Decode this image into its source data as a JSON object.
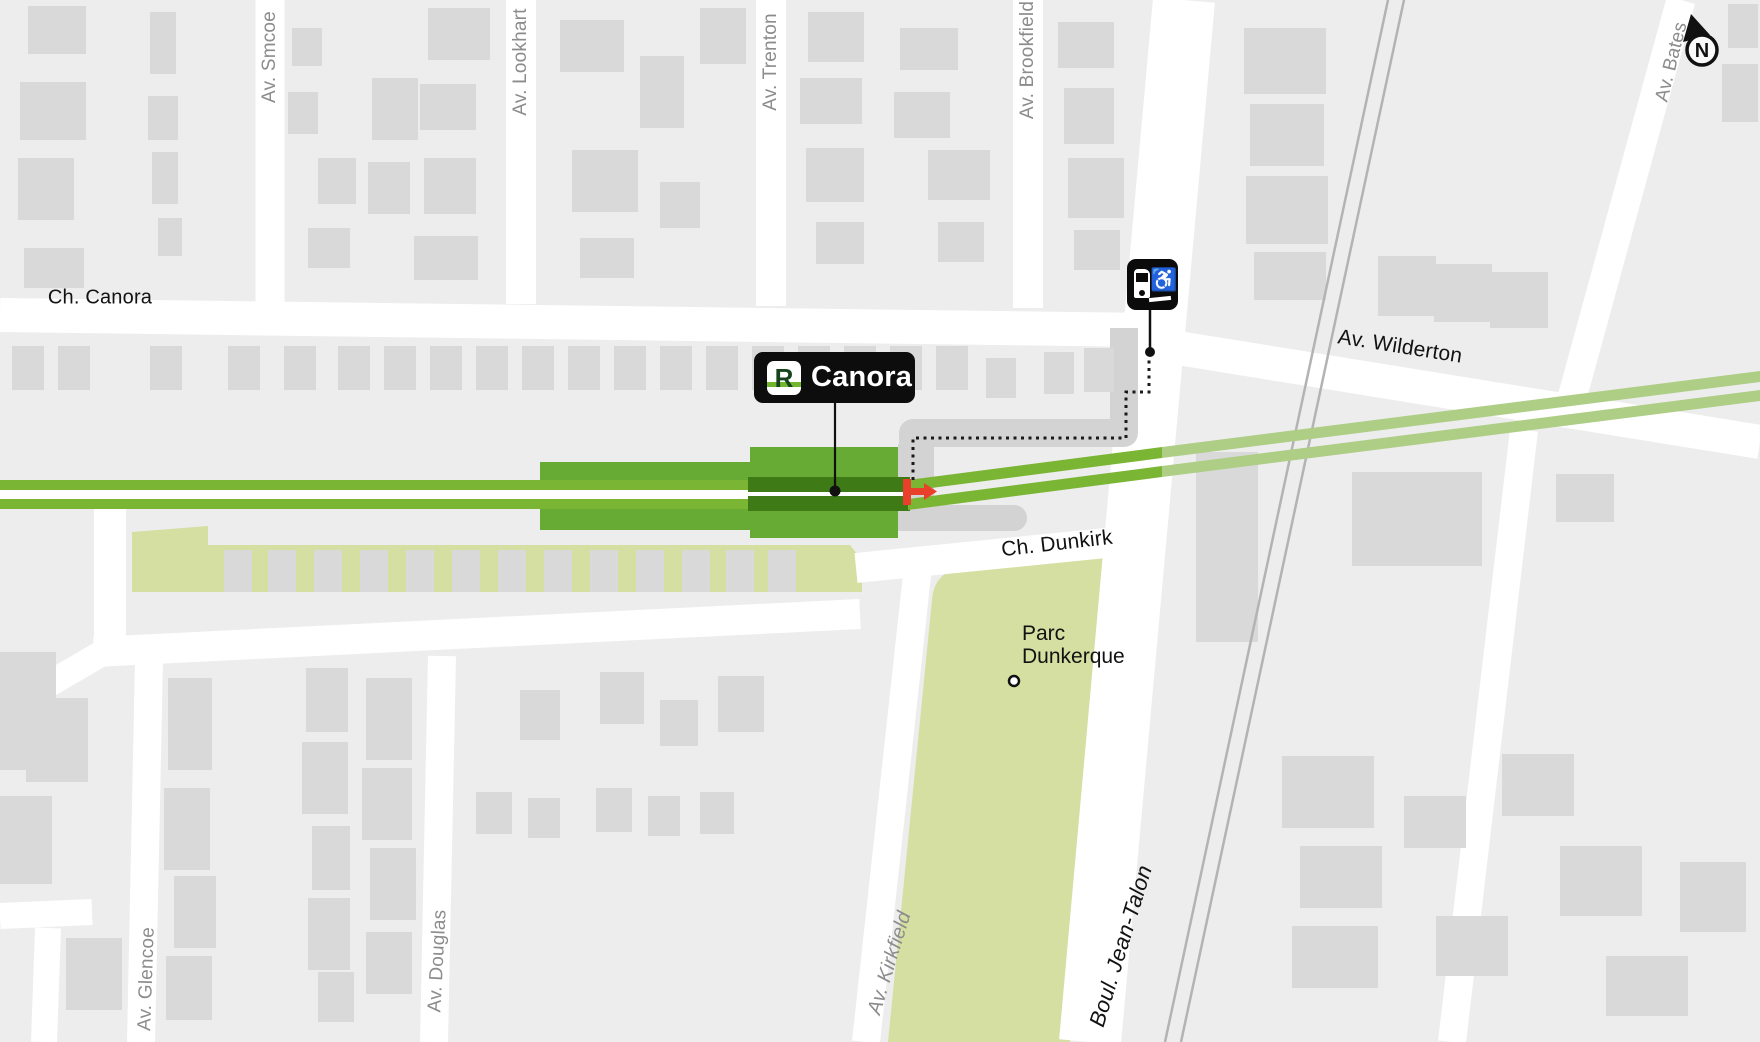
{
  "station_label": {
    "logo_letter": "R",
    "name": "Canora"
  },
  "compass": {
    "letter": "N"
  },
  "streets": {
    "ch_canora": "Ch. Canora",
    "av_smcoe": "Av. Smcoe",
    "av_lookhart": "Av. Lookhart",
    "av_trenton": "Av. Trenton",
    "av_brookfield": "Av. Brookfield",
    "av_wilderton": "Av. Wilderton",
    "av_bates": "Av. Bates",
    "ch_dunkirk": "Ch. Dunkirk",
    "av_kirkfield": "Av. Kirkfield",
    "boul_jean_talon": "Boul. Jean-Talon",
    "av_glencoe": "Av. Glencoe",
    "av_douglas": "Av. Douglas"
  },
  "park": {
    "line1": "Parc",
    "line2": "Dunkerque"
  },
  "icons": {
    "wheelchair_glyph": "♿"
  },
  "colors": {
    "rem_line_green": "#7AB534",
    "rem_dark_green": "#3E7A15",
    "station_green": "#67AB35",
    "faded_line_green": "#AECD85",
    "park_green": "#D4DFA1",
    "entrance_red": "#E8402B",
    "street_white": "#FFFFFF",
    "building_gray": "#D9D9D9",
    "background_gray": "#EDEDED",
    "label_gray": "#8C8C8C"
  }
}
